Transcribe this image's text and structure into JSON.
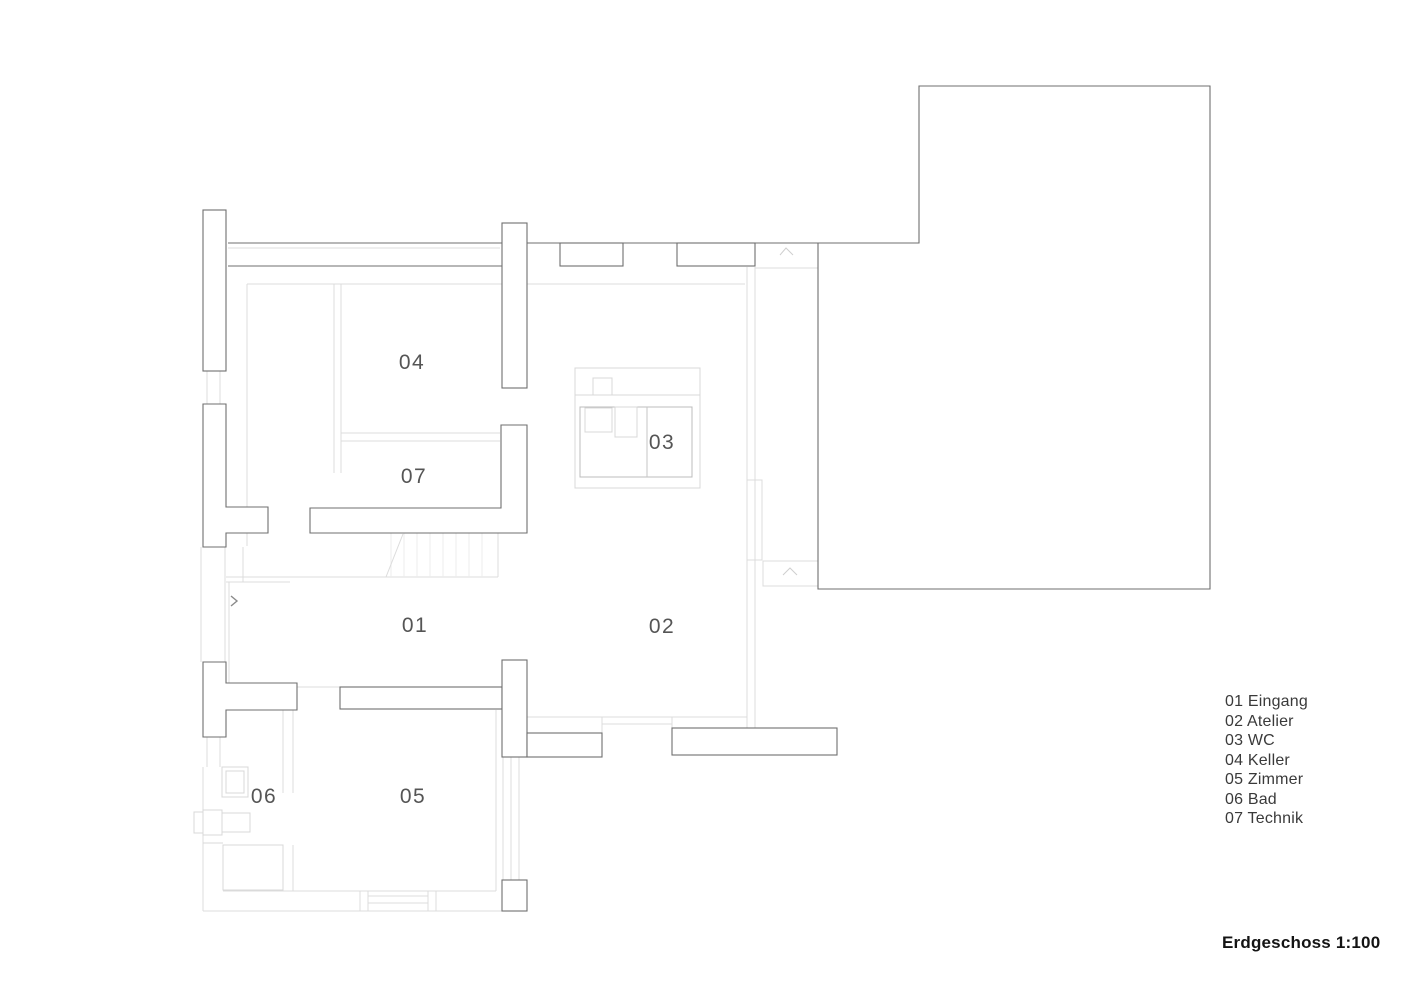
{
  "colors": {
    "background": "#ffffff",
    "wall_line": "#6f6f6f",
    "light_line": "#dcdcdc",
    "faint_line": "#ececec",
    "label_text": "#555555",
    "legend_text": "#3a3a3a",
    "title_text": "#141414"
  },
  "plan": {
    "room_labels": [
      {
        "id": "01",
        "text": "01"
      },
      {
        "id": "02",
        "text": "02"
      },
      {
        "id": "03",
        "text": "03"
      },
      {
        "id": "04",
        "text": "04"
      },
      {
        "id": "05",
        "text": "05"
      },
      {
        "id": "06",
        "text": "06"
      },
      {
        "id": "07",
        "text": "07"
      }
    ]
  },
  "legend": {
    "items": [
      "01 Eingang",
      "02 Atelier",
      "03 WC",
      "04 Keller",
      "05 Zimmer",
      "06 Bad",
      "07 Technik"
    ]
  },
  "footer": {
    "scale_label": "Erdgeschoss 1:100"
  },
  "icons": {
    "entrance_arrow": "chevron-right",
    "connection_mark": "caret-up"
  }
}
